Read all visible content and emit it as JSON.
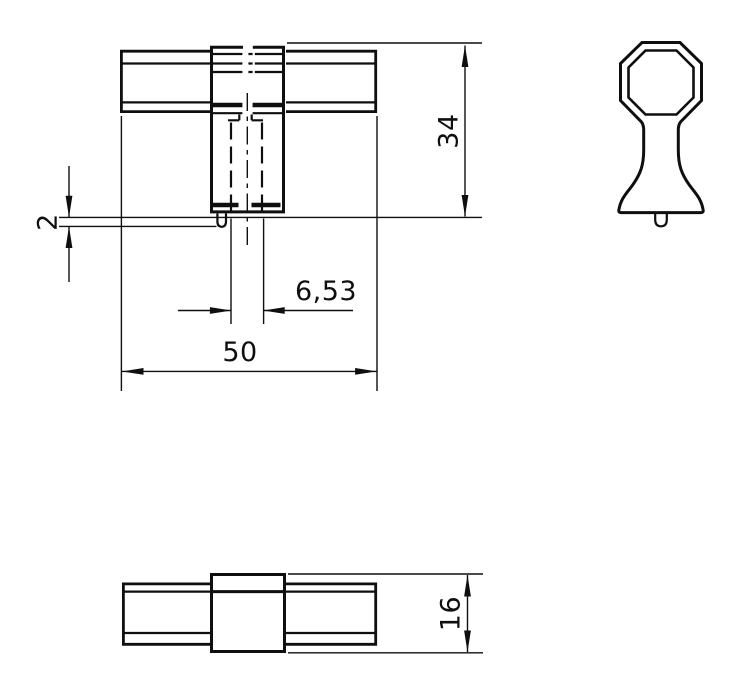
{
  "palette": {
    "background": "#ffffff",
    "line_color": "#0f0f0f"
  },
  "dimensions": {
    "overall_height": "34",
    "pin_height": "2",
    "hole_width": "6,53",
    "overall_width": "50",
    "bar_thickness": "16"
  }
}
